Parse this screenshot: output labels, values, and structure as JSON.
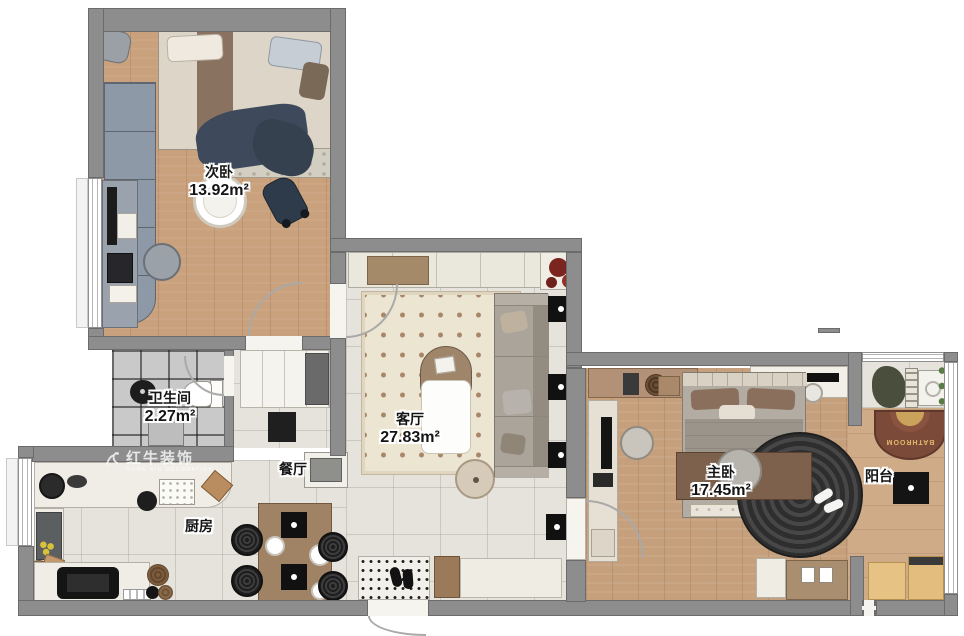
{
  "plan": {
    "rooms": {
      "secondary_bedroom": {
        "label": "次卧",
        "area": "13.92m²"
      },
      "bathroom": {
        "label": "卫生间",
        "area": "2.27m²"
      },
      "dining": {
        "label": "餐厅",
        "area": ""
      },
      "kitchen": {
        "label": "厨房",
        "area": ""
      },
      "living": {
        "label": "客厅",
        "area": "27.83m²"
      },
      "master_bedroom": {
        "label": "主卧",
        "area": "17.45m²"
      },
      "balcony": {
        "label": "阳台",
        "area": ""
      }
    },
    "watermark": {
      "brand": "红牛装饰",
      "tagline": "HONG NIU DECORATION"
    },
    "mats": {
      "balcony_doormat": "BATHROOM"
    },
    "colors": {
      "wall": "#8d8d8d",
      "wood_floor": "#c9a17c",
      "tile_floor": "#e6e3dc",
      "bath_tile": "#c9c9c9",
      "living_rug": "#ece5d1",
      "rug_dots": "#a8876a",
      "dark_rug": "#3a3a3a",
      "navy_blanket": "#3e4a5b",
      "mat_brown": "#7b4a38",
      "wardrobe_blue": "#8e99a7"
    }
  }
}
